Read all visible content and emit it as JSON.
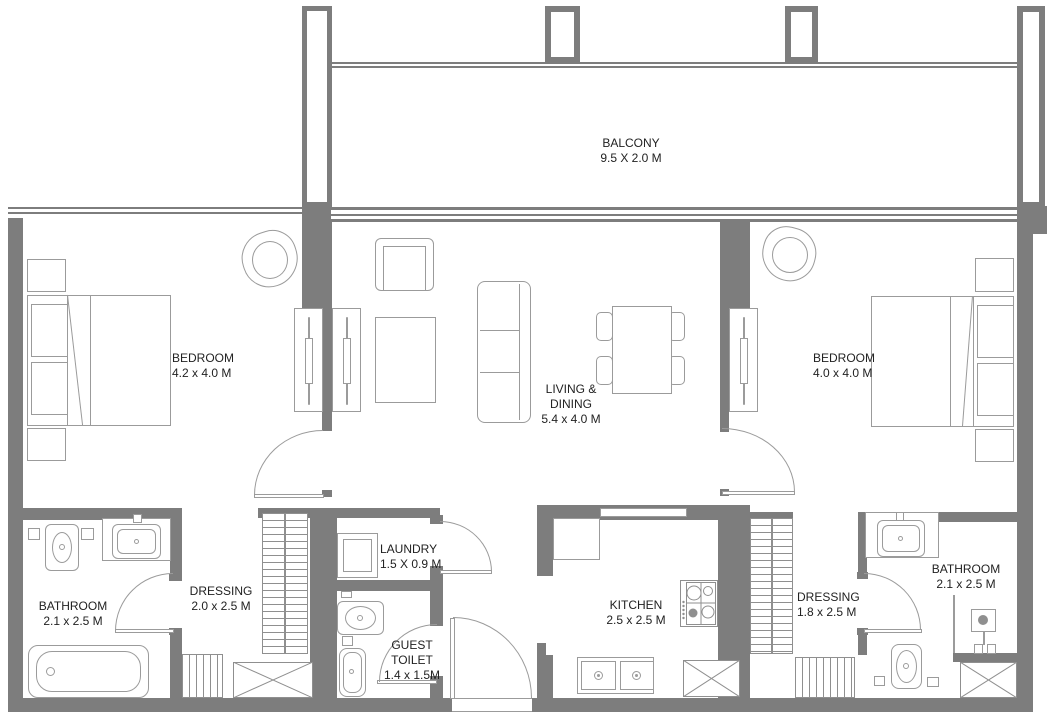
{
  "rooms": {
    "balcony": {
      "name": "BALCONY",
      "dims": "9.5 X 2.0 M"
    },
    "bedroom_left": {
      "name": "BEDROOM",
      "dims": "4.2 x 4.0 M"
    },
    "living_dining": {
      "name_line1": "LIVING &",
      "name_line2": "DINING",
      "dims": "5.4 x 4.0 M"
    },
    "bedroom_right": {
      "name": "BEDROOM",
      "dims": "4.0 x 4.0 M"
    },
    "bathroom_left": {
      "name": "BATHROOM",
      "dims": "2.1 x 2.5 M"
    },
    "dressing_left": {
      "name": "DRESSING",
      "dims": "2.0 x 2.5 M"
    },
    "laundry": {
      "name": "LAUNDRY",
      "dims": "1.5 X 0.9 M"
    },
    "guest_toilet": {
      "name_line1": "GUEST",
      "name_line2": "TOILET",
      "dims": "1.4 x 1.5M"
    },
    "kitchen": {
      "name": "KITCHEN",
      "dims": "2.5 x 2.5 M"
    },
    "dressing_right": {
      "name": "DRESSING",
      "dims": "1.8 x 2.5 M"
    },
    "bathroom_right": {
      "name": "BATHROOM",
      "dims": "2.1 x 2.5 M"
    }
  },
  "colors": {
    "wall": "#7d7d7d",
    "furniture_line": "#9b9b9b",
    "text": "#222222",
    "background": "#ffffff"
  }
}
